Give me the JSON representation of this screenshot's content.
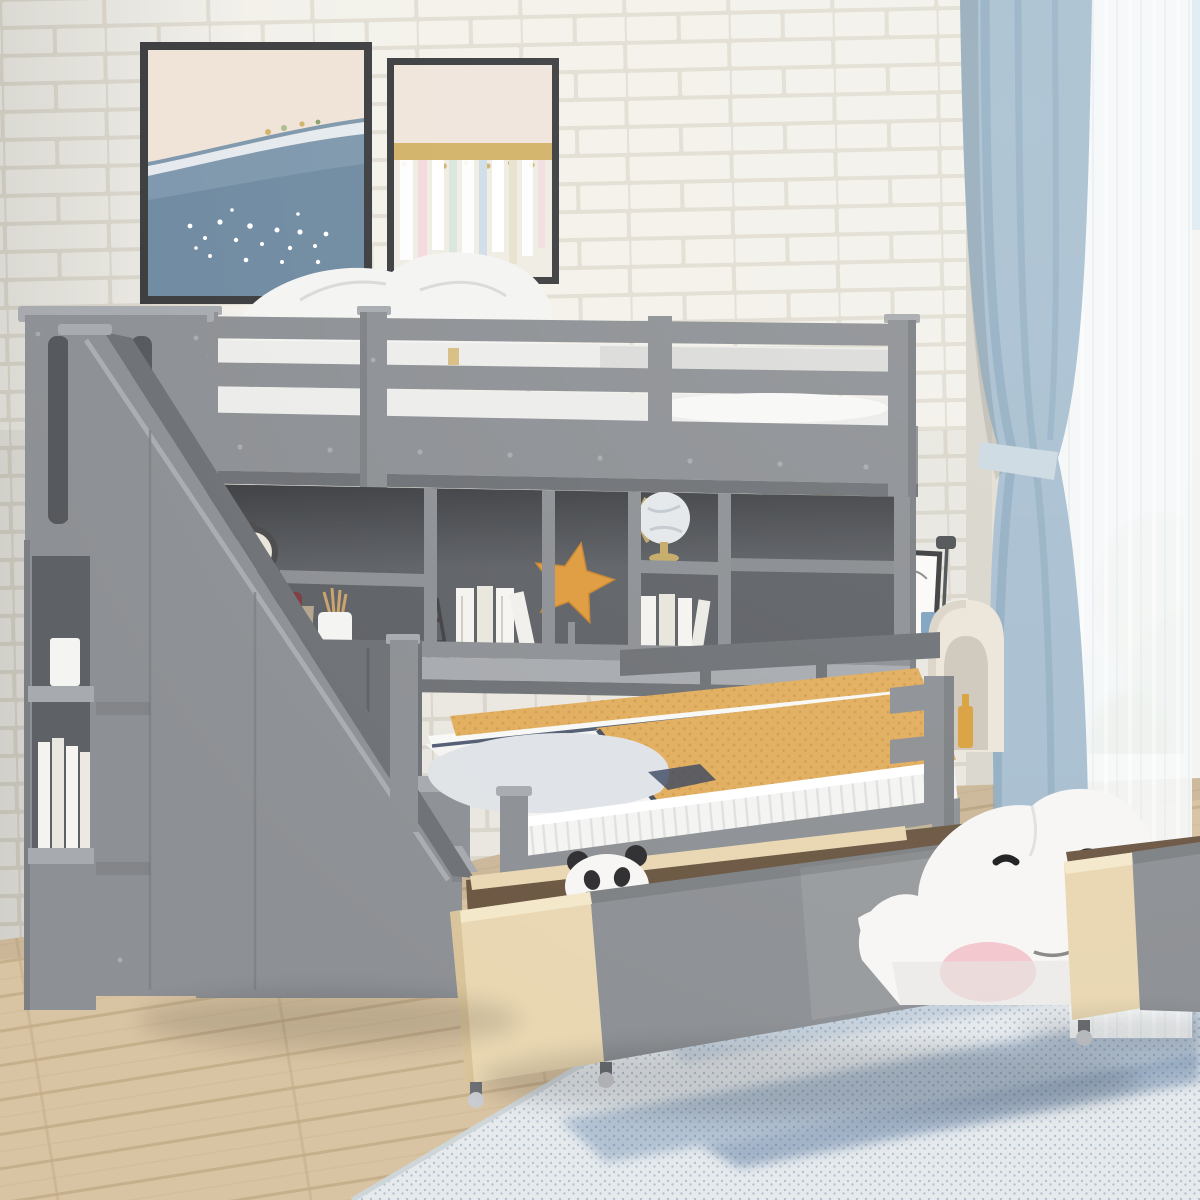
{
  "scene": {
    "type": "furniture-product-photo",
    "description": "Gray wooden twin-over-full bunk bed with storage staircase, built-in bookcase and desk, and two rolling under-bed storage drawers, staged in a bedroom with white brick wall, two canvas prints, blue curtains, light oak floor and a blue speckled rug.",
    "room": {
      "wall": "white painted brick",
      "window": "right side with sheer and steel-blue blackout curtain, greenery outside",
      "floor": "light oak plank",
      "rug": "white and blue mottled area rug"
    },
    "furniture": {
      "bed": "twin over full bunk bed, gray finish",
      "left": "storage staircase with open side shelves and cupboards",
      "middle": "under-loft bookcase with long desk surface",
      "bottom": "two pull-out drawers on casters, birch sides with gray fronts",
      "right": "white writing desk and cream arch pet-house"
    },
    "decor": {
      "wall_art": [
        "ocean wave canvas print",
        "gold-band pastel abstract canvas print"
      ],
      "shelf_items": [
        "black alarm clock",
        "woven basket with red cloth",
        "white pencil cup with pencils",
        "white books",
        "tower figurine",
        "orange starfish ornament on book stack",
        "world globe with gold base",
        "more white books"
      ],
      "stair_shelf_items": [
        "white books",
        "small white box"
      ],
      "desk_items": [
        "brown vase with pampas grass",
        "black picture frame",
        "thin desk lamp",
        "blue cup"
      ],
      "drawer_items": [
        "panda plush",
        "small striped plush",
        "large white whale plush with pink cheek"
      ],
      "other": [
        "amber bottle inside arch niche"
      ]
    },
    "textiles": {
      "top_bunk": "white mattress, pillows and duvet",
      "lower_bed": "white fitted sheet, pale gray folded sheet, mustard waffle blanket with navy piping",
      "curtains": "steel blue panel with tieback plus white sheer"
    },
    "palette": {
      "wallMortar": "#e2ded3",
      "wallBrick": "#f3f1ea",
      "wallShade": "#d9d6cd",
      "gray": "#8d9094",
      "grayLight": "#a7aaae",
      "grayDark": "#6e7175",
      "grayDeep": "#55585c",
      "interior": "#5e6166",
      "white": "#f4f4f2",
      "bedding": "#ececea",
      "beddingShade": "#d8d9d8",
      "sheet": "#dfe3e7",
      "navy": "#36425c",
      "blanket": "#e2ae5e",
      "blanketDark": "#c4903f",
      "birch": "#e9d7b2",
      "birchDark": "#d9c49a",
      "drawerWoodDark": "#6b5742",
      "floorWood": "#d8c3a2",
      "floorLine": "#c2ab87",
      "rugBase": "#e6eaed",
      "rugBlue": "#8aa3bd",
      "rugBlueDark": "#3f6490",
      "curtainBlue": "#a8bfd0",
      "curtainBlueDark": "#83a2b8",
      "curtainTie": "#cdd9e2",
      "sheer": "#f6f8fa",
      "sky": "#dfeaf2",
      "foliageLight": "#c9d6ae",
      "foliage": "#a9bd8b",
      "foliageDark": "#8aa06c",
      "frameDark": "#3a3c3e",
      "canvasCream": "#f0e3d8",
      "canvasSea": "#7e97ac",
      "canvasSeaDark": "#5f7d96",
      "gold": "#d2b267",
      "abstractBase": "#efece4",
      "starfish": "#df9b3c",
      "clockFace": "#ebe6da",
      "clockRim": "#4b4b4d",
      "basket": "#b3a48e",
      "redCloth": "#7e3b42",
      "globeSphere": "#e4e8ea",
      "globeGold": "#c4aa66",
      "vase": "#8a5a3a",
      "pampas": "#d9c8a2",
      "archCream": "#ece5d8",
      "archInner": "#cfc8bc",
      "bottleAmber": "#d9a13e",
      "plushWhite": "#f7f6f4",
      "plushPink": "#f3c7cd",
      "plushBlack": "#2e2e30",
      "deskWhite": "#edebe5",
      "lampDark": "#4e5154",
      "cupBlue": "#7fa3c0"
    }
  }
}
